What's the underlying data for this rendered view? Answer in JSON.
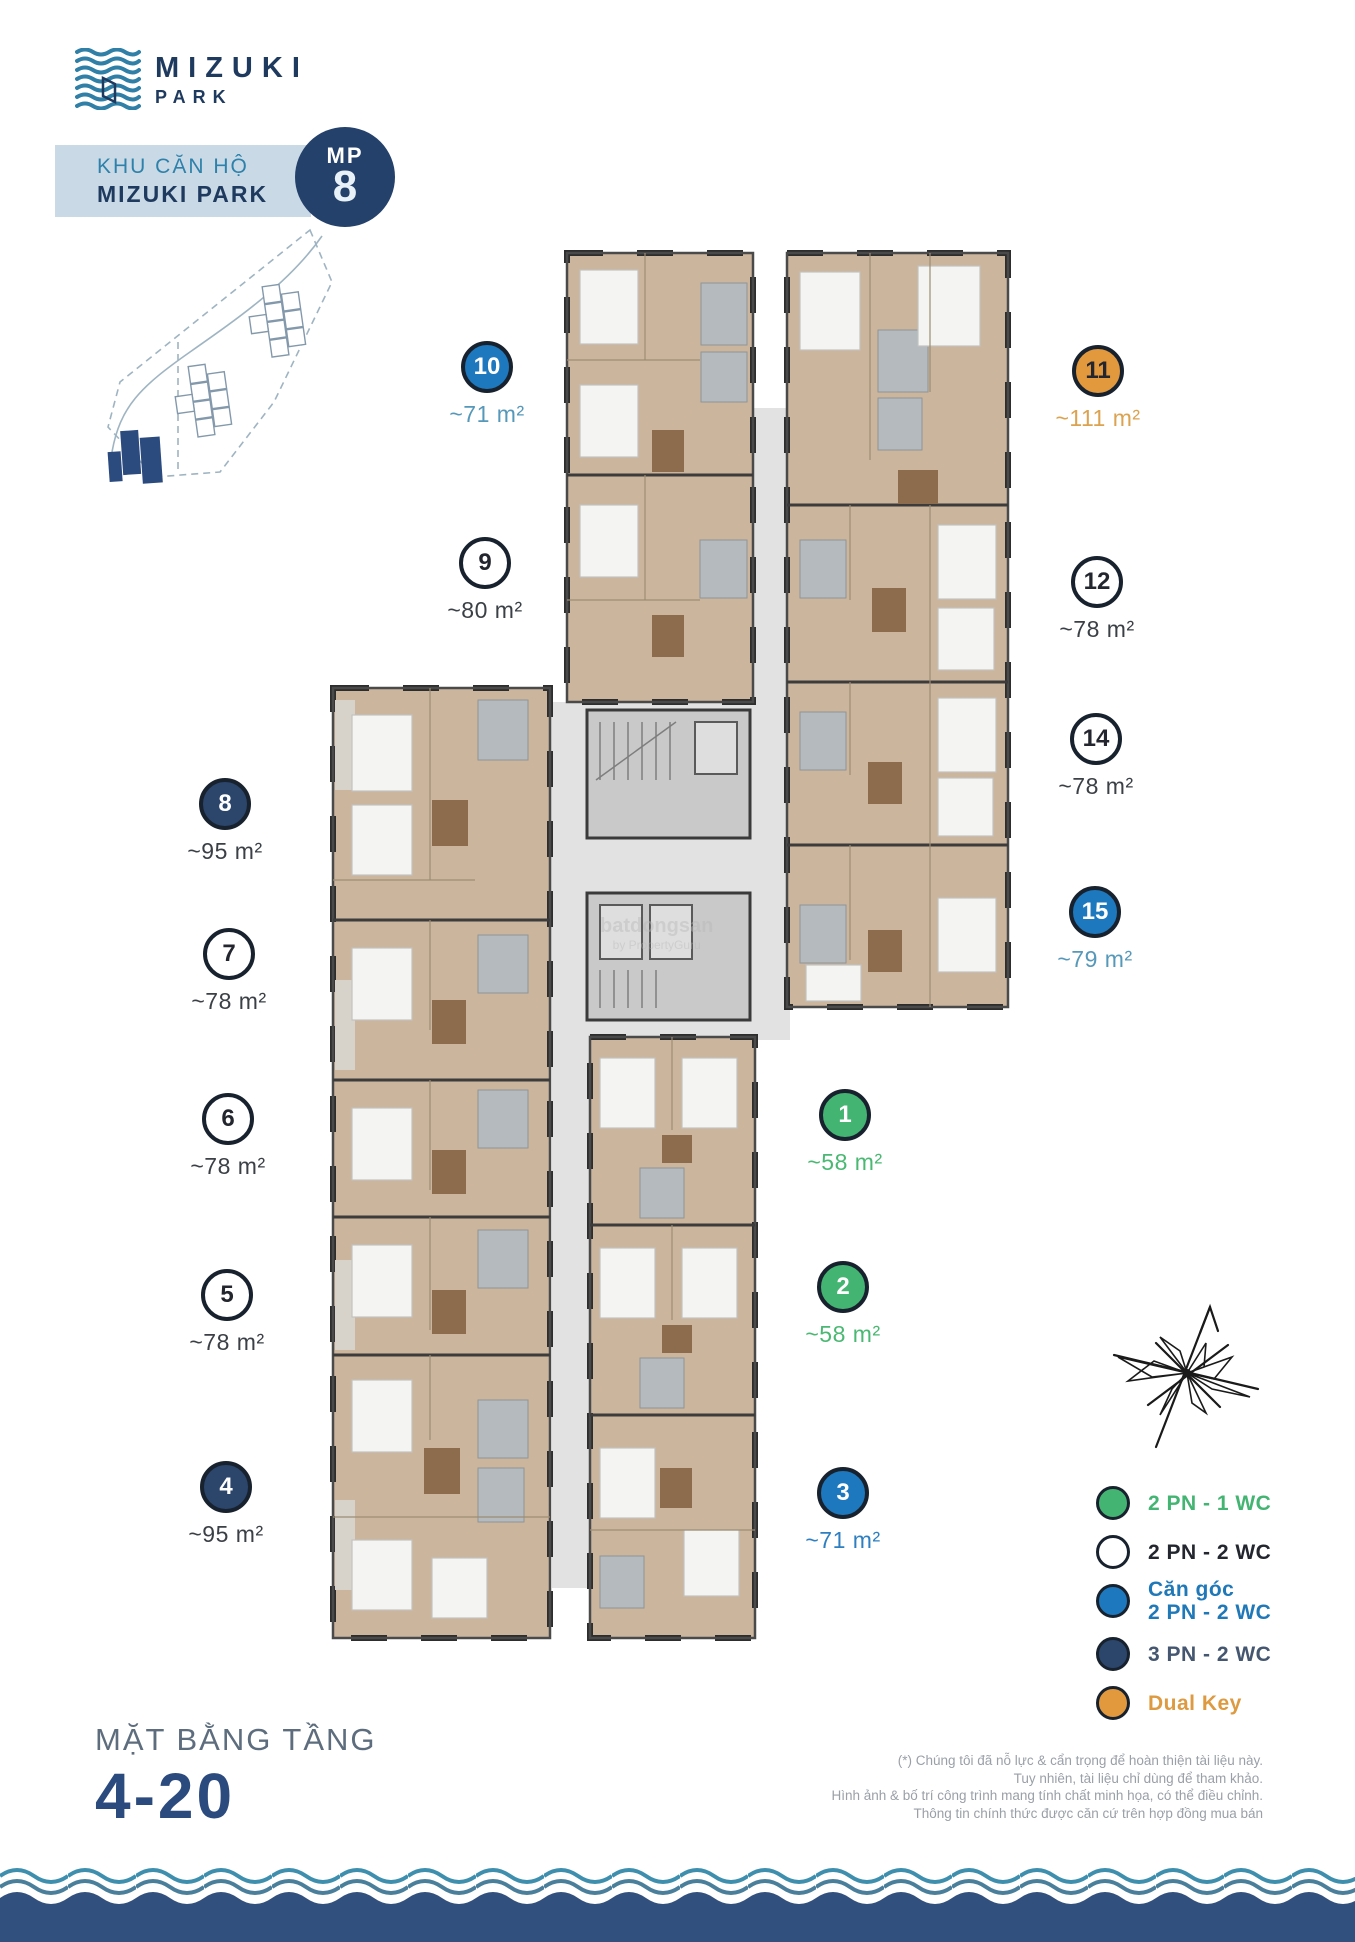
{
  "header": {
    "logo_line1": "MIZUKI",
    "logo_line2": "PARK",
    "banner_subtitle": "KHU CĂN HỘ",
    "banner_title": "MIZUKI PARK",
    "badge_prefix": "MP",
    "badge_number": "8"
  },
  "units": [
    {
      "number": "1",
      "area": "~58 m²",
      "type": "green"
    },
    {
      "number": "2",
      "area": "~58 m²",
      "type": "green"
    },
    {
      "number": "3",
      "area": "~71 m²",
      "type": "blue"
    },
    {
      "number": "4",
      "area": "~95 m²",
      "type": "navy"
    },
    {
      "number": "5",
      "area": "~78 m²",
      "type": "white"
    },
    {
      "number": "6",
      "area": "~78 m²",
      "type": "white"
    },
    {
      "number": "7",
      "area": "~78 m²",
      "type": "white"
    },
    {
      "number": "8",
      "area": "~95 m²",
      "type": "navy"
    },
    {
      "number": "9",
      "area": "~80 m²",
      "type": "white"
    },
    {
      "number": "10",
      "area": "~71 m²",
      "type": "blue"
    },
    {
      "number": "11",
      "area": "~111 m²",
      "type": "orange"
    },
    {
      "number": "12",
      "area": "~78 m²",
      "type": "white"
    },
    {
      "number": "14",
      "area": "~78 m²",
      "type": "white"
    },
    {
      "number": "15",
      "area": "~79 m²",
      "type": "blue"
    }
  ],
  "legend": {
    "items": [
      {
        "key": "green",
        "label": "2 PN - 1 WC",
        "sublabel": ""
      },
      {
        "key": "white",
        "label": "2 PN - 2 WC",
        "sublabel": ""
      },
      {
        "key": "blue",
        "label": "Căn góc",
        "sublabel": "2 PN - 2 WC"
      },
      {
        "key": "navy",
        "label": "3 PN - 2 WC",
        "sublabel": ""
      },
      {
        "key": "orange",
        "label": "Dual Key",
        "sublabel": ""
      }
    ]
  },
  "floor_title": {
    "label": "MẶT BẰNG TẦNG",
    "floors": "4-20"
  },
  "disclaimer": {
    "line1": "(*) Chúng tôi đã nỗ lực & cẩn trọng để hoàn thiện tài liệu này.",
    "line2": "Tuy nhiên, tài liệu chỉ dùng để tham khảo.",
    "line3": "Hình ảnh & bố trí công trình mang tính chất minh họa, có thể điều chỉnh.",
    "line4": "Thông tin chính thức được căn cứ trên hợp đồng mua bán"
  },
  "watermark": {
    "line1": "batdongsan",
    "line2": "by PropertyGuru"
  },
  "colors": {
    "navy": "#2b456b",
    "blue": "#1d78be",
    "green": "#43b471",
    "orange": "#e2983d",
    "white": "#ffffff",
    "band": "#c9dae6",
    "teal_text": "#2e81ab",
    "title_navy": "#2b4a7d",
    "wave_navy": "#32507d",
    "wave_teal": "#3e8fae",
    "floor_wood": "#ccb59d"
  }
}
